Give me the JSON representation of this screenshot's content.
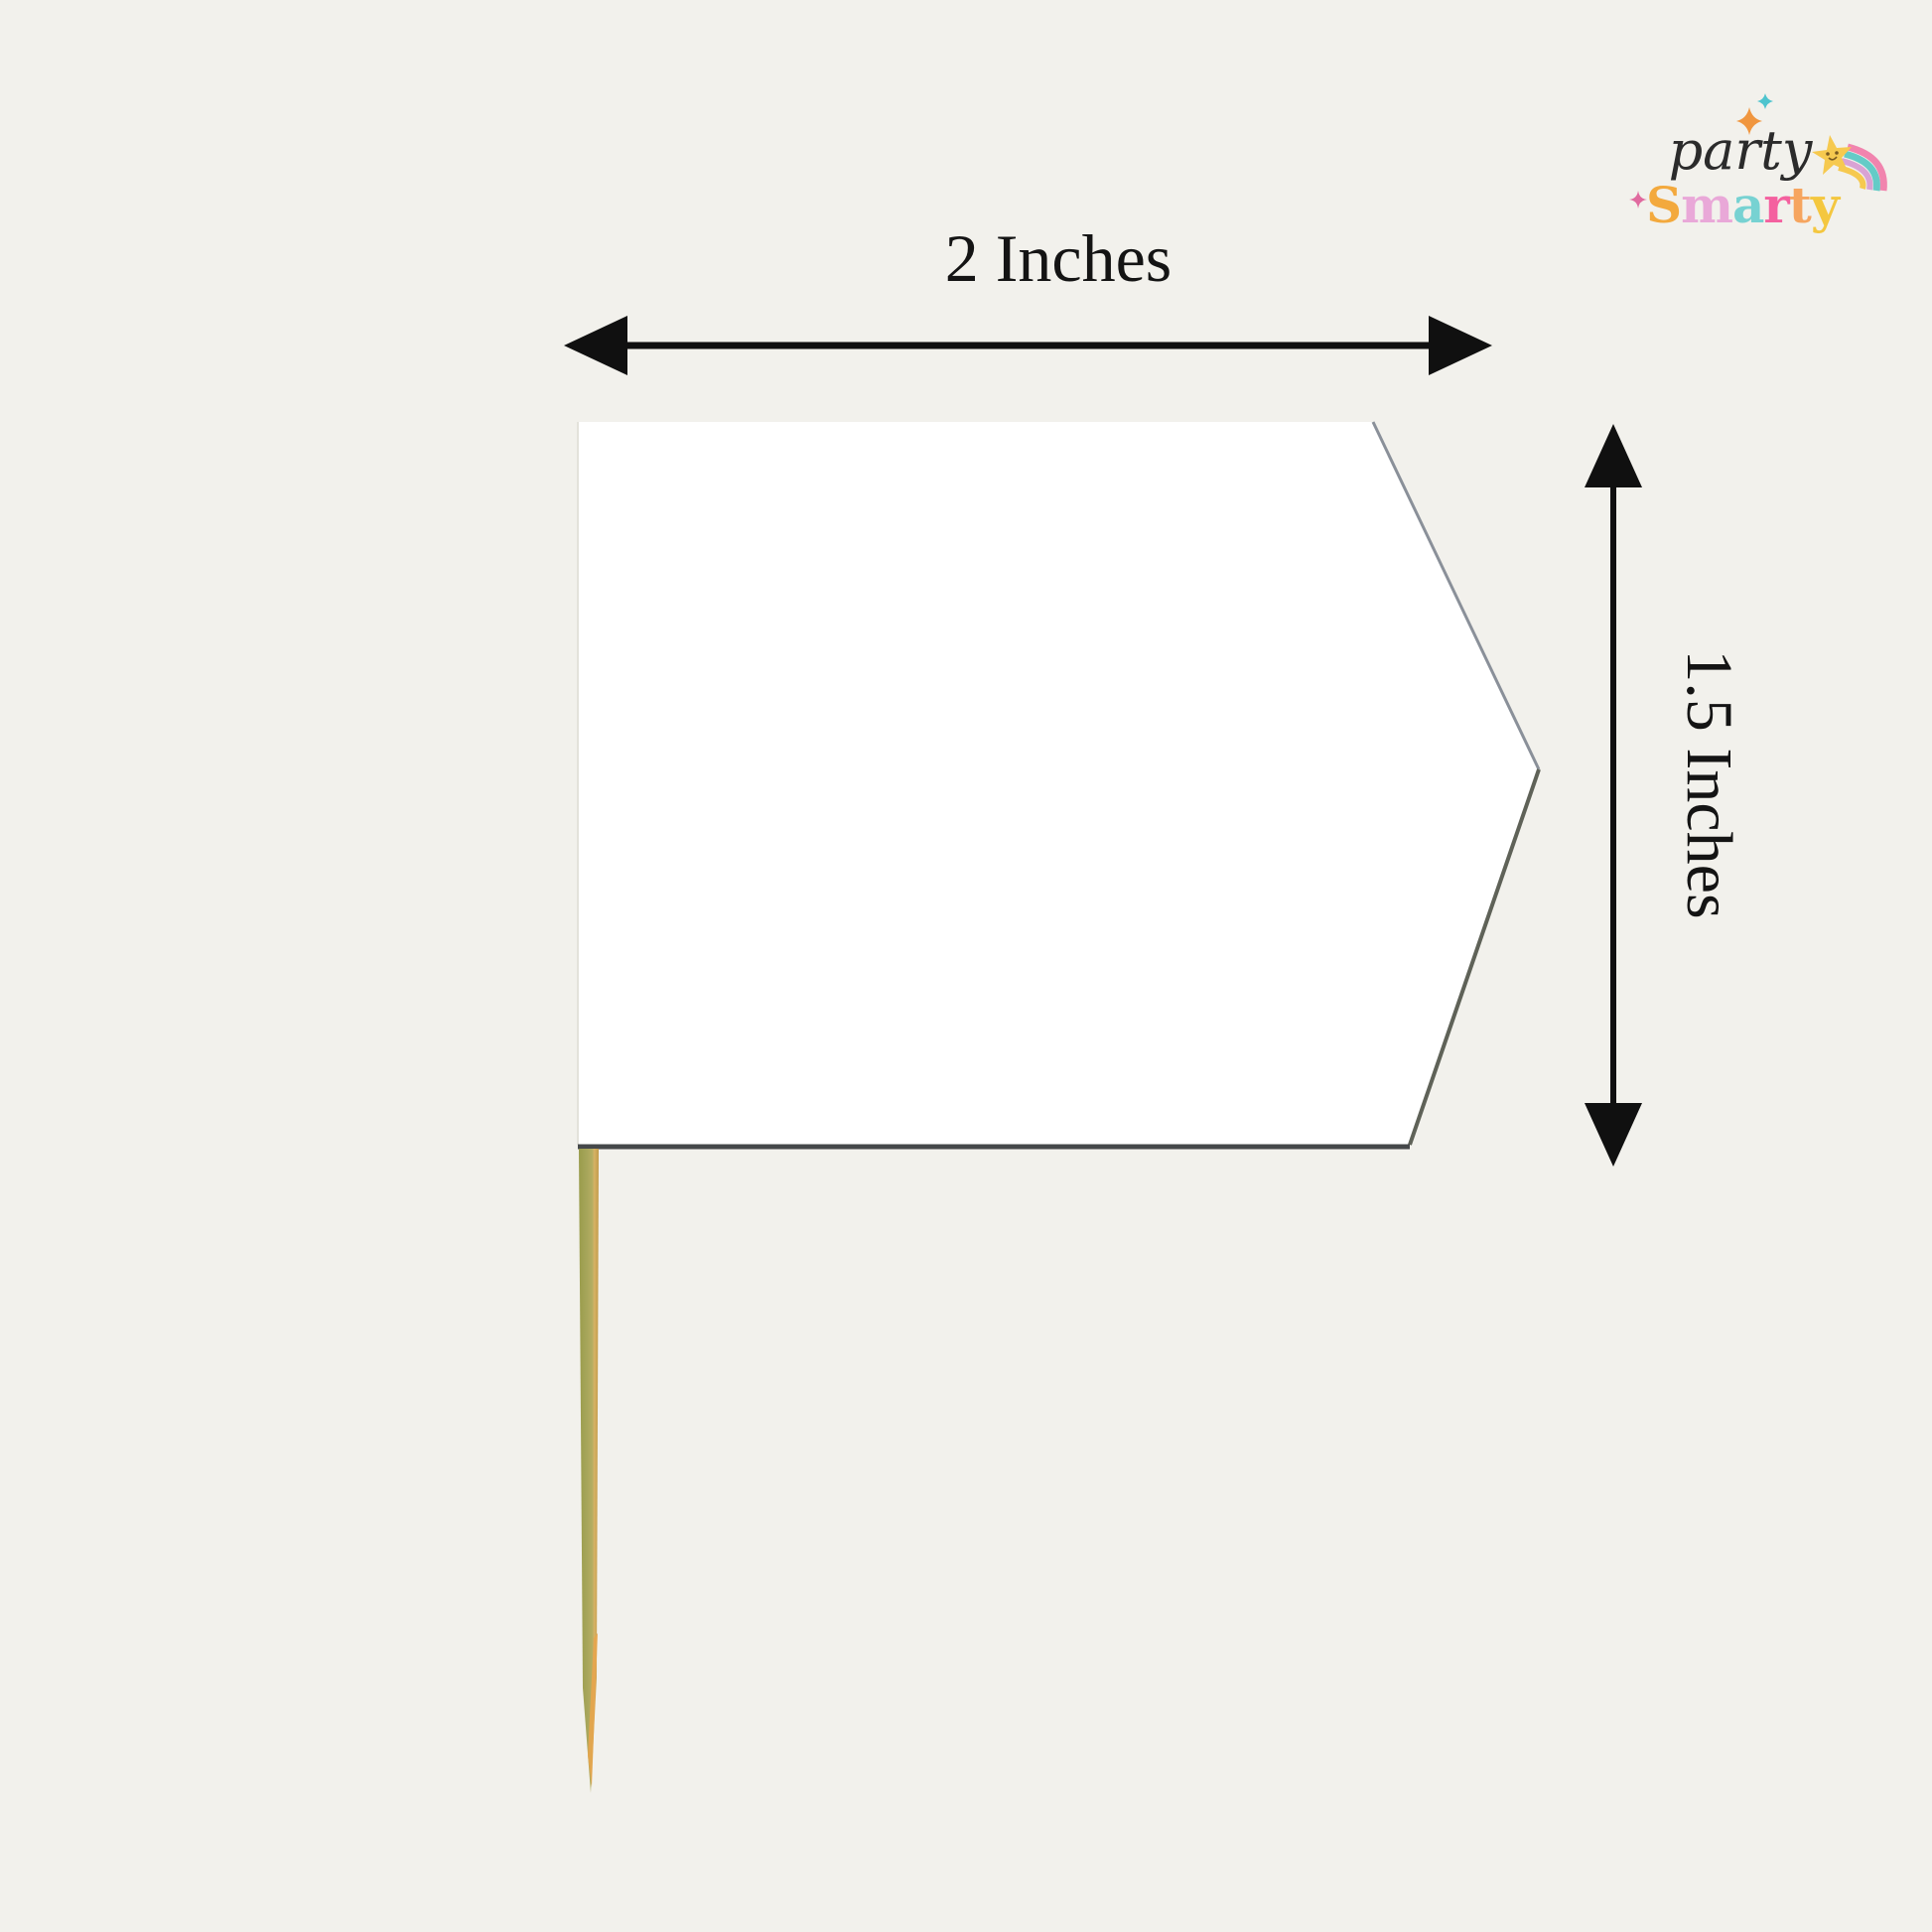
{
  "background": "#f2f1ec",
  "logo": {
    "script_word": "party",
    "script_color": "#2b2b2b",
    "brand_word_letters": [
      {
        "char": "S",
        "color": "#F3A93D"
      },
      {
        "char": "m",
        "color": "#E9A8D8"
      },
      {
        "char": "a",
        "color": "#77D2D2"
      },
      {
        "char": "r",
        "color": "#F4609F"
      },
      {
        "char": "t",
        "color": "#F6A55F"
      },
      {
        "char": "y",
        "color": "#F4C73F"
      }
    ],
    "sparkles": {
      "orange": "#F0963F",
      "teal": "#4EC4CE",
      "pink": "#E06A9F"
    },
    "shooting_star": {
      "star_color": "#F6C94F",
      "face_color": "#7a5a20",
      "rainbow_colors": [
        "#F184AE",
        "#64CBC7",
        "#D9A3D4",
        "#F6C94F"
      ]
    }
  },
  "dimension_labels": {
    "width": "2 Inches",
    "height": "1.5 Inches",
    "arrow_color": "#101010"
  },
  "flag": {
    "fill": "#ffffff",
    "edge_top_right": "#8a9099",
    "edge_bottom_right": "#5f6258",
    "edge_bottom": "#45484a",
    "edge_left": "#e3e2db"
  },
  "stick": {
    "gradient": [
      "#999c4c",
      "#a9a75c",
      "#b4ad62",
      "#d7b264",
      "#c09a4a"
    ],
    "tip_color": "#e7a54d"
  }
}
